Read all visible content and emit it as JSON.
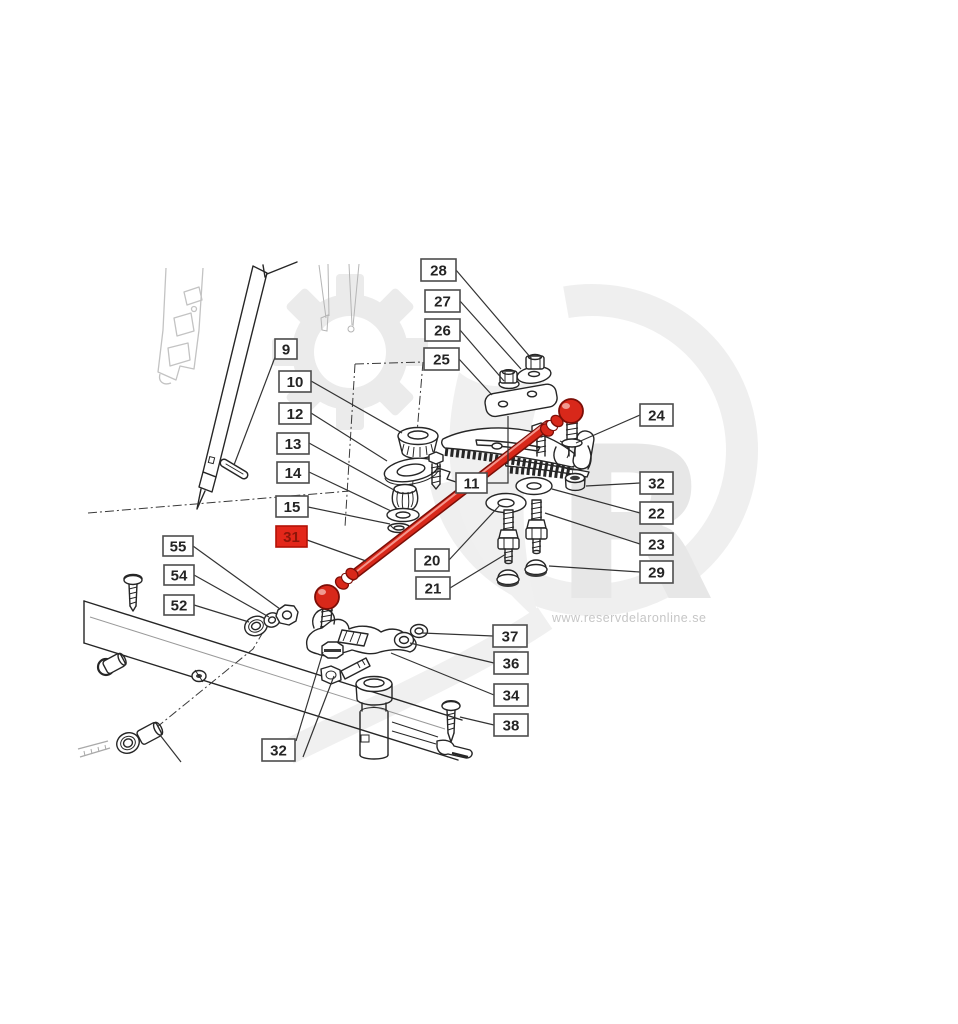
{
  "watermark": {
    "url_text": "www.reservdelaronline.se",
    "letter": "R",
    "description": "light gray gear, swoosh ring and R logo behind drawing"
  },
  "highlighted_part": "31",
  "colors": {
    "red": "#d8281a",
    "red_dark": "#7c0e07",
    "red_light": "#f4948b",
    "label_red_bg": "#e3271a",
    "label_red_text": "#8d1509",
    "line": "#262626",
    "faint": "#c3c3c3",
    "watermark_gray": "#ebebeb",
    "watermark_text": "#c6c6c6"
  },
  "callouts": [
    {
      "id": "28",
      "label": "28",
      "x": 421,
      "y": 259,
      "w": 35,
      "h": 22,
      "highlighted": false,
      "leaders": [
        [
          [
            456,
            270
          ],
          [
            531,
            358
          ]
        ]
      ]
    },
    {
      "id": "27",
      "label": "27",
      "x": 425,
      "y": 290,
      "w": 35,
      "h": 22,
      "highlighted": false,
      "leaders": [
        [
          [
            460,
            301
          ],
          [
            521,
            369
          ]
        ]
      ]
    },
    {
      "id": "26",
      "label": "26",
      "x": 425,
      "y": 319,
      "w": 35,
      "h": 22,
      "highlighted": false,
      "leaders": [
        [
          [
            460,
            330
          ],
          [
            504,
            381
          ]
        ]
      ]
    },
    {
      "id": "25",
      "label": "25",
      "x": 424,
      "y": 348,
      "w": 35,
      "h": 22,
      "highlighted": false,
      "leaders": [
        [
          [
            459,
            359
          ],
          [
            492,
            395
          ]
        ]
      ]
    },
    {
      "id": "9",
      "label": "9",
      "x": 275,
      "y": 339,
      "w": 22,
      "h": 20,
      "highlighted": false,
      "leaders": [
        [
          [
            277,
            352
          ],
          [
            234,
            465
          ]
        ]
      ]
    },
    {
      "id": "10",
      "label": "10",
      "x": 279,
      "y": 371,
      "w": 32,
      "h": 21,
      "highlighted": false,
      "leaders": [
        [
          [
            311,
            381
          ],
          [
            402,
            433
          ]
        ]
      ]
    },
    {
      "id": "12",
      "label": "12",
      "x": 279,
      "y": 403,
      "w": 32,
      "h": 21,
      "highlighted": false,
      "leaders": [
        [
          [
            311,
            413
          ],
          [
            387,
            461
          ]
        ]
      ]
    },
    {
      "id": "13",
      "label": "13",
      "x": 277,
      "y": 433,
      "w": 32,
      "h": 21,
      "highlighted": false,
      "leaders": [
        [
          [
            309,
            443
          ],
          [
            394,
            490
          ]
        ]
      ]
    },
    {
      "id": "14",
      "label": "14",
      "x": 277,
      "y": 462,
      "w": 32,
      "h": 21,
      "highlighted": false,
      "leaders": [
        [
          [
            309,
            472
          ],
          [
            391,
            511
          ]
        ]
      ]
    },
    {
      "id": "15",
      "label": "15",
      "x": 276,
      "y": 496,
      "w": 32,
      "h": 21,
      "highlighted": false,
      "leaders": [
        [
          [
            308,
            507
          ],
          [
            390,
            524
          ]
        ]
      ]
    },
    {
      "id": "31",
      "label": "31",
      "x": 276,
      "y": 526,
      "w": 31,
      "h": 21,
      "highlighted": true,
      "leaders": [
        [
          [
            307,
            540
          ],
          [
            366,
            561
          ]
        ]
      ]
    },
    {
      "id": "11",
      "label": "11",
      "x": 456,
      "y": 473,
      "w": 31,
      "h": 20,
      "highlighted": false,
      "leaders": [
        [
          [
            487,
            483
          ],
          [
            508,
            483
          ],
          [
            508,
            416
          ]
        ]
      ]
    },
    {
      "id": "24",
      "label": "24",
      "x": 640,
      "y": 404,
      "w": 33,
      "h": 22,
      "highlighted": false,
      "leaders": [
        [
          [
            640,
            415
          ],
          [
            576,
            443
          ]
        ]
      ]
    },
    {
      "id": "32-right",
      "label": "32",
      "x": 640,
      "y": 472,
      "w": 33,
      "h": 22,
      "highlighted": false,
      "leaders": [
        [
          [
            640,
            483
          ],
          [
            586,
            486
          ]
        ]
      ]
    },
    {
      "id": "22",
      "label": "22",
      "x": 640,
      "y": 502,
      "w": 33,
      "h": 22,
      "highlighted": false,
      "leaders": [
        [
          [
            640,
            513
          ],
          [
            552,
            489
          ]
        ]
      ]
    },
    {
      "id": "23",
      "label": "23",
      "x": 640,
      "y": 533,
      "w": 33,
      "h": 22,
      "highlighted": false,
      "leaders": [
        [
          [
            640,
            544
          ],
          [
            545,
            513
          ]
        ]
      ]
    },
    {
      "id": "29",
      "label": "29",
      "x": 640,
      "y": 561,
      "w": 33,
      "h": 22,
      "highlighted": false,
      "leaders": [
        [
          [
            640,
            572
          ],
          [
            549,
            566
          ]
        ]
      ]
    },
    {
      "id": "20",
      "label": "20",
      "x": 415,
      "y": 549,
      "w": 34,
      "h": 22,
      "highlighted": false,
      "leaders": [
        [
          [
            449,
            560
          ],
          [
            500,
            505
          ]
        ]
      ]
    },
    {
      "id": "21",
      "label": "21",
      "x": 416,
      "y": 577,
      "w": 34,
      "h": 22,
      "highlighted": false,
      "leaders": [
        [
          [
            450,
            588
          ],
          [
            506,
            554
          ]
        ]
      ]
    },
    {
      "id": "37",
      "label": "37",
      "x": 493,
      "y": 625,
      "w": 34,
      "h": 22,
      "highlighted": false,
      "leaders": [
        [
          [
            493,
            636
          ],
          [
            422,
            633
          ]
        ]
      ]
    },
    {
      "id": "36",
      "label": "36",
      "x": 494,
      "y": 652,
      "w": 34,
      "h": 22,
      "highlighted": false,
      "leaders": [
        [
          [
            494,
            663
          ],
          [
            410,
            643
          ]
        ]
      ]
    },
    {
      "id": "34",
      "label": "34",
      "x": 494,
      "y": 684,
      "w": 34,
      "h": 22,
      "highlighted": false,
      "leaders": [
        [
          [
            494,
            695
          ],
          [
            391,
            653
          ]
        ]
      ]
    },
    {
      "id": "38",
      "label": "38",
      "x": 494,
      "y": 714,
      "w": 34,
      "h": 22,
      "highlighted": false,
      "leaders": [
        [
          [
            494,
            725
          ],
          [
            460,
            717
          ]
        ]
      ]
    },
    {
      "id": "55",
      "label": "55",
      "x": 163,
      "y": 536,
      "w": 30,
      "h": 20,
      "highlighted": false,
      "leaders": [
        [
          [
            193,
            546
          ],
          [
            280,
            609
          ]
        ]
      ]
    },
    {
      "id": "54",
      "label": "54",
      "x": 164,
      "y": 565,
      "w": 30,
      "h": 20,
      "highlighted": false,
      "leaders": [
        [
          [
            194,
            575
          ],
          [
            269,
            617
          ]
        ]
      ]
    },
    {
      "id": "52",
      "label": "52",
      "x": 164,
      "y": 595,
      "w": 30,
      "h": 20,
      "highlighted": false,
      "leaders": [
        [
          [
            194,
            605
          ],
          [
            249,
            622
          ]
        ]
      ]
    },
    {
      "id": "32-bottom",
      "label": "32",
      "x": 262,
      "y": 739,
      "w": 33,
      "h": 22,
      "highlighted": false,
      "leaders": [
        [
          [
            296,
            741
          ],
          [
            323,
            652
          ]
        ],
        [
          [
            303,
            757
          ],
          [
            334,
            676
          ]
        ]
      ]
    }
  ]
}
